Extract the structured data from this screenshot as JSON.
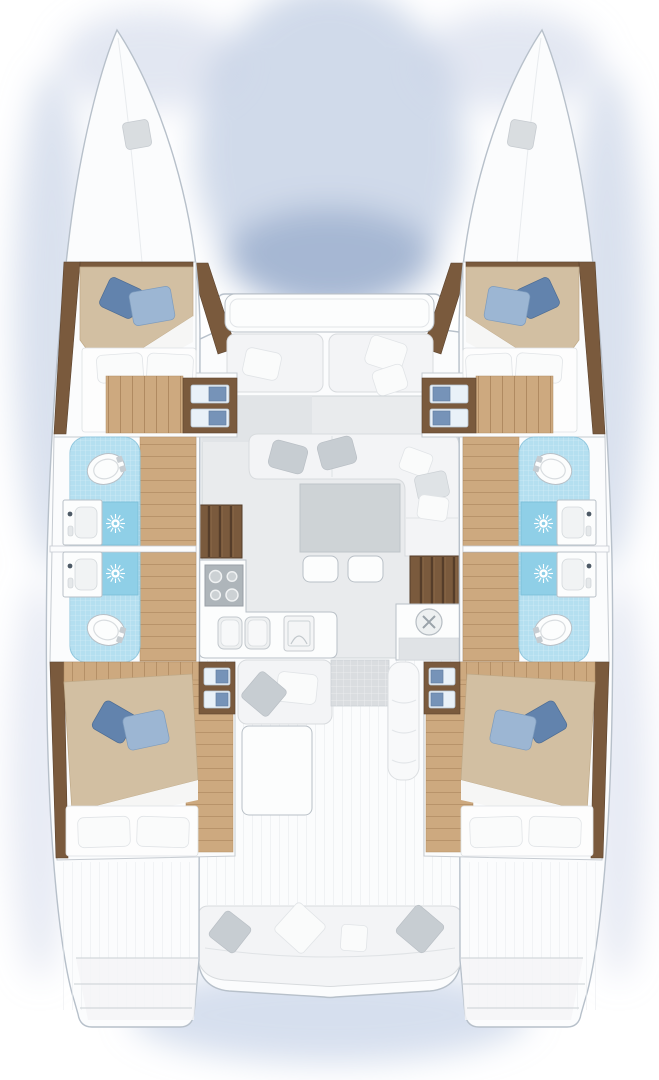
{
  "diagram": {
    "type": "floor-plan",
    "subject": "catamaran yacht deck and accommodation layout, top view",
    "layout_summary": {
      "double_cabins": 4,
      "heads": 4,
      "shower_trays": 4,
      "toilets": 4,
      "washbasins": 6,
      "companionway_stairs": 2,
      "bow_hatches": 2,
      "saloon": 1,
      "galley": 1,
      "cockpit_benches": 2,
      "transom_platforms": 2
    },
    "sections": {
      "port_hull": [
        "bow-deck",
        "forward-cabin",
        "forward-head",
        "aft-head",
        "aft-cabin",
        "transom-steps"
      ],
      "starboard_hull": [
        "bow-deck",
        "forward-cabin",
        "forward-head",
        "aft-head",
        "aft-cabin",
        "transom-steps"
      ],
      "bridgedeck": [
        "foredeck-bench",
        "saloon-sofa",
        "saloon-table",
        "stools",
        "galley",
        "port-companionway",
        "starboard-companionway",
        "cockpit",
        "aft-bench"
      ]
    },
    "symbols": [
      "shower-drain-sun-icon",
      "cooktop-burner-icon",
      "double-sink-icon",
      "oven-icon",
      "round-sink-icon",
      "toilet-icon",
      "washbasin-icon",
      "deck-hatch-icon"
    ]
  },
  "colors": {
    "background": "#ffffff",
    "water_shadow": "#9fb2d2",
    "hull_white": "#fbfcfd",
    "hull_outline": "#b7c0ca",
    "wood_floor": "#cda97f",
    "wood_dark": "#7a5a3d",
    "bed_spread_tan": "#d2bfa2",
    "bed_fold_white": "#f6f6f5",
    "mattress_white": "#fdfdfd",
    "pillow_blue_dark": "#6283ad",
    "pillow_blue_light": "#9cb6d3",
    "bath_tile_blue": "#b4dff0",
    "shower_tray_blue": "#8fcfe7",
    "porcelain_white": "#fcfdfd",
    "fixture_outline": "#b9c0c7",
    "sofa_white": "#f3f4f6",
    "cushion_gray": "#c7cdd2",
    "saloon_floor_gray": "#e9ebed",
    "table_gray": "#ced3d6",
    "cooktop_gray": "#aeb5ba",
    "hatch_gray": "#d9dde0"
  }
}
